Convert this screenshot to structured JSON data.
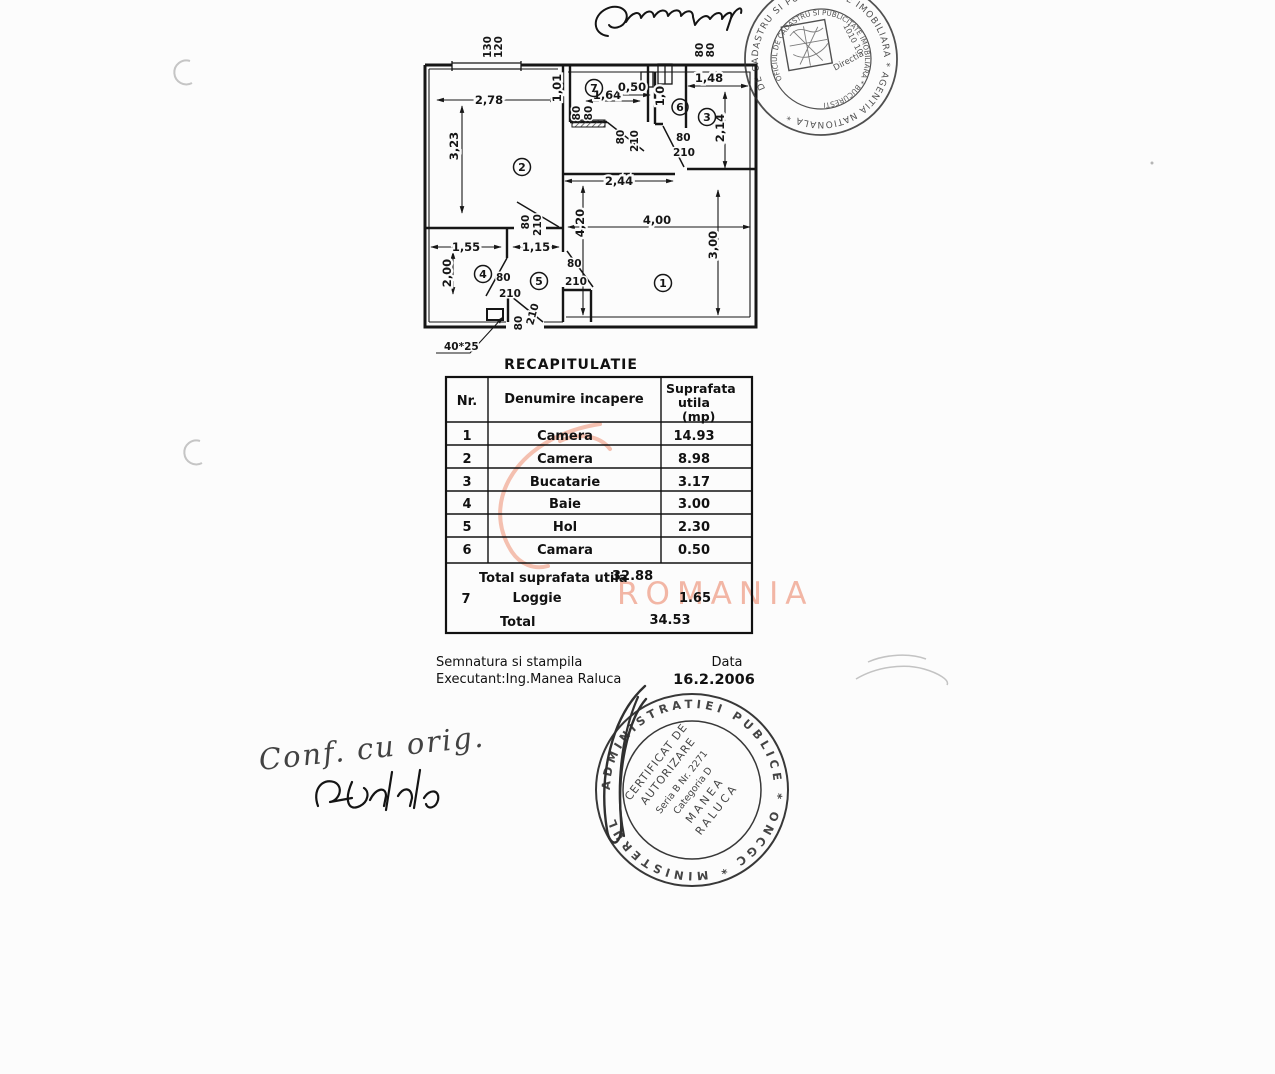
{
  "page": {
    "background": "#fcfcfc",
    "ink": "#1a1a1a",
    "watermark_color": "#f2b6a5"
  },
  "plan": {
    "top_labels": {
      "l1": "130",
      "l2": "120",
      "r1": "80",
      "r2": "80"
    },
    "dims": {
      "d1": "2,78",
      "d2": "3,23",
      "d3": "1,55",
      "d4": "2,00",
      "d5": "1,15",
      "d6": "2,44",
      "d7": "4,20",
      "d8": "4,00",
      "d9": "3,00",
      "d10": "1,48",
      "d11": "2,14",
      "d12": "1,64",
      "d13": "0,50",
      "d14": "1,01",
      "d15": "1,0"
    },
    "doors": {
      "a1": "80",
      "a2": "80",
      "b1": "80",
      "b2": "210",
      "c1": "80",
      "c2": "210",
      "d1": "80",
      "d2": "210",
      "e1": "80",
      "e2": "210",
      "f1": "80",
      "f2": "210",
      "g1": "80",
      "g2": "210"
    },
    "rooms": {
      "r1": "1",
      "r2": "2",
      "r3": "3",
      "r4": "4",
      "r5": "5",
      "r6": "6",
      "r7": "7"
    },
    "column_label": "40*25"
  },
  "table": {
    "title": "RECAPITULATIE",
    "headers": {
      "nr": "Nr.",
      "name": "Denumire incapere",
      "area1": "Suprafata",
      "area2": "utila",
      "area3": "(mp)"
    },
    "rows": [
      {
        "nr": "1",
        "name": "Camera",
        "area": "14.93"
      },
      {
        "nr": "2",
        "name": "Camera",
        "area": "8.98"
      },
      {
        "nr": "3",
        "name": "Bucatarie",
        "area": "3.17"
      },
      {
        "nr": "4",
        "name": "Baie",
        "area": "3.00"
      },
      {
        "nr": "5",
        "name": "Hol",
        "area": "2.30"
      },
      {
        "nr": "6",
        "name": "Camara",
        "area": "0.50"
      }
    ],
    "subtotal_label": "Total suprafata utila",
    "subtotal_value": "32.88",
    "row7": {
      "nr": "7",
      "name": "Loggie",
      "area": "1.65"
    },
    "total_label": "Total",
    "total_value": "34.53"
  },
  "footer": {
    "line1": "Semnatura si stampila",
    "line2": "Executant:Ing.Manea Raluca",
    "date_label": "Data",
    "date_value": "16.2.2006"
  },
  "stamps": {
    "top": {
      "ring_outer": "DE CADASTRU SI PUBLICITATE IMOBILIARA * AGENTIA NATIONALA *",
      "ring_inner": "OFICIUL DE CADASTRU SI PUBLICITATE IMOBILIARA * BUCURESTI",
      "code": "1010 10",
      "dir": "Directia"
    },
    "bottom": {
      "ring": "ADMINISTRATIEI  PUBLICE  *  ONCGC  *  MINISTERUL",
      "line1": "CERTIFICAT DE",
      "line2": "AUTORIZARE",
      "line3": "Seria B Nr. 2271",
      "line4": "Categoria D",
      "line5": "MANEA",
      "line6": "RALUCA"
    }
  },
  "handwriting": {
    "note": "Conf. cu orig."
  },
  "watermark": {
    "text": "ROMANIA"
  }
}
